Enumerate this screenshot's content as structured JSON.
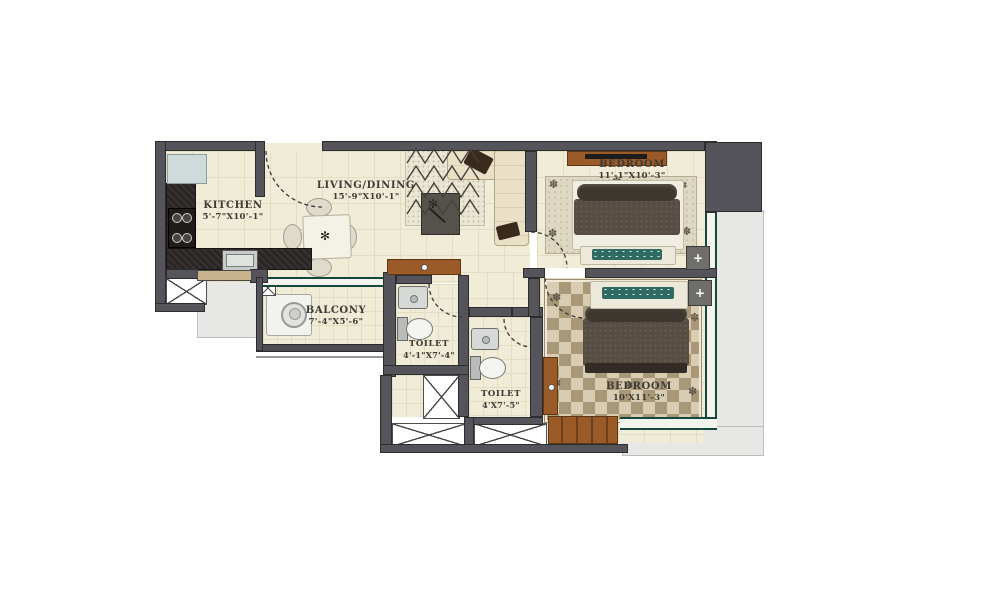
{
  "plan_title": "2 BHK floor plan",
  "rooms": {
    "kitchen": {
      "name": "KITCHEN",
      "dims": "5'-7\"X10'-1\""
    },
    "living": {
      "name": "LIVING/DINING",
      "dims": "15'-9\"X10'-1\""
    },
    "bedroom1": {
      "name": "BEDROOM",
      "dims": "11'-1\"X10'-3\""
    },
    "balcony": {
      "name": "BALCONY",
      "dims": "7'-4\"X5'-6\""
    },
    "toilet1": {
      "name": "TOILET",
      "dims": "4'-1\"X7'-4\""
    },
    "toilet2": {
      "name": "TOILET",
      "dims": "4'X7'-5\""
    },
    "bedroom2": {
      "name": "BEDROOM",
      "dims": "10'X11'-3\""
    }
  },
  "icons": {
    "plant": "✻",
    "floret": "✽",
    "lamp_plus": "+"
  },
  "colors": {
    "wall": "#55545a",
    "floor": "#f1ecd8",
    "wood": "#9a5b28",
    "window": "#16473f",
    "ledge": "#e7e7e5",
    "duvet": "#584d43",
    "teal_pillow": "#2f6b63"
  }
}
